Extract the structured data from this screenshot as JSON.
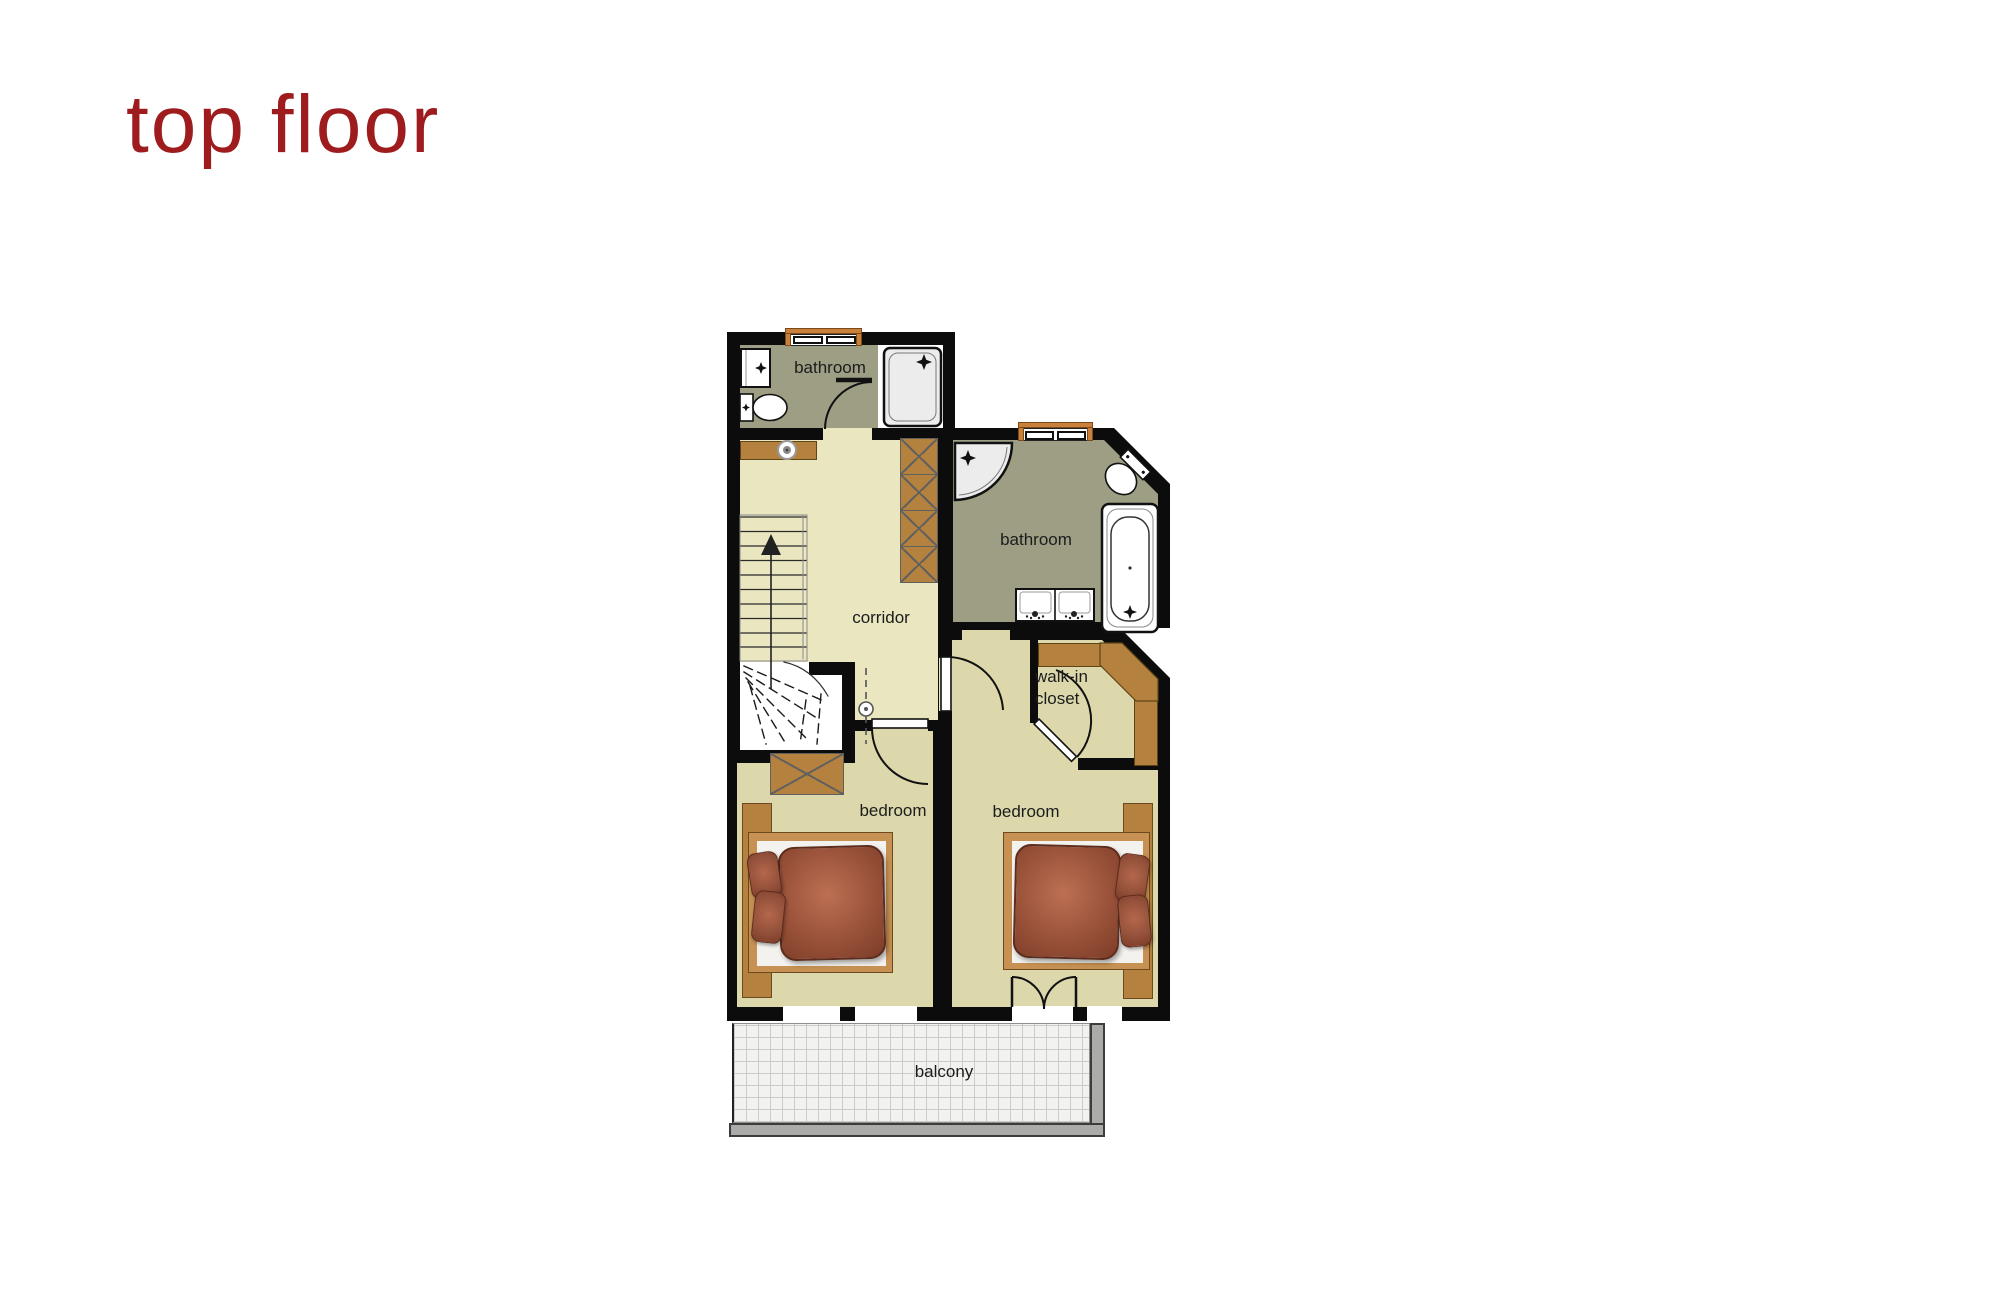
{
  "page": {
    "title": "top floor",
    "title_color": "#9e1b1e",
    "background_color": "#ffffff"
  },
  "floorplan": {
    "rooms": {
      "bathroom_top": {
        "label": "bathroom"
      },
      "bathroom_right": {
        "label": "bathroom"
      },
      "corridor": {
        "label": "corridor"
      },
      "walk_in_closet": {
        "label_line1": "walk-in",
        "label_line2": "closet"
      },
      "bedroom_left": {
        "label": "bedroom"
      },
      "bedroom_right": {
        "label": "bedroom"
      },
      "balcony": {
        "label": "balcony"
      }
    },
    "fixtures": [
      "staircase",
      "shower",
      "corner-shower",
      "bathtub",
      "washbasin",
      "double-washbasin",
      "toilet",
      "bed",
      "wardrobe",
      "walk-in-wardrobe",
      "console",
      "french-door",
      "window"
    ],
    "icons": {
      "sparkle": "four-point star on shower/basin fixtures",
      "up-arrow": "stair direction arrow"
    },
    "palette": {
      "wall": "#0c0c0c",
      "corridor_floor": "#eae7c0",
      "bedroom_floor": "#dcd8ab",
      "bathroom_floor": "#9e9e85",
      "wood": "#b5813f",
      "bed_textile": "#9a523a",
      "balcony_tile": "#f2f2f0",
      "railing": "#ababa9",
      "window_frame": "#c8803b"
    }
  }
}
